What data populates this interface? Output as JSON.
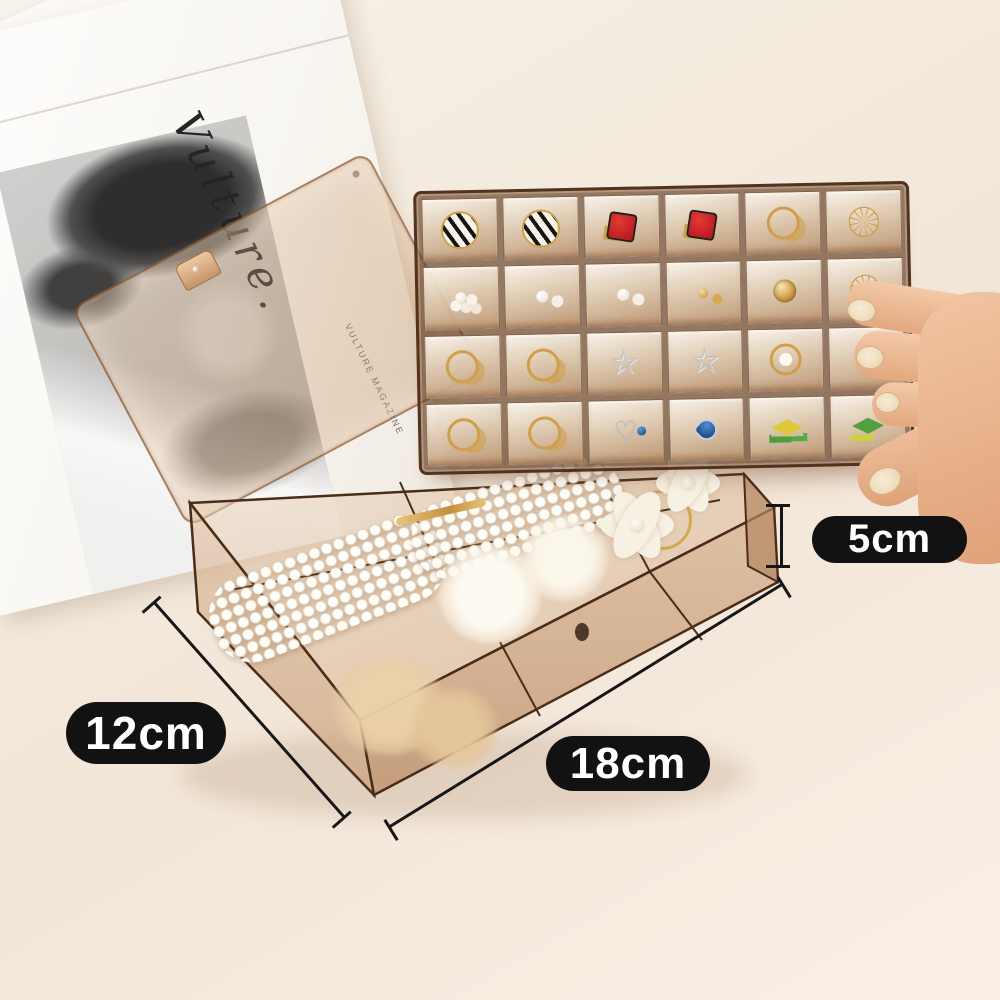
{
  "annotations": {
    "height_label": "5cm",
    "side_label": "12cm",
    "front_label": "18cm"
  },
  "magazine": {
    "script_title": "Vulture.",
    "caption": "VULTURE MAGAZINE"
  },
  "tray": {
    "rows": 4,
    "cols": 6,
    "items": [
      "striped-circle",
      "striped-circle",
      "red-square",
      "red-square",
      "gold-hoop",
      "wire-ball",
      "pearl-cluster",
      "pearl-stud",
      "pearl-stud",
      "gold-stud",
      "gold-ball",
      "wire-ball",
      "gold-hoop",
      "gold-hoop",
      "silver-star",
      "silver-star",
      "gold-flower",
      "gold-crystal",
      "gold-hoop",
      "gold-hoop",
      "silver-heart",
      "blue-gem",
      "yellow-bow",
      "green-bow"
    ]
  },
  "box": {
    "items": [
      "pearl-barrette",
      "pearl-barrette",
      "gold-clip",
      "gold-ring-tie",
      "flower-hair-ties",
      "fur-pom-poms",
      "beige-scrunchie"
    ]
  },
  "icons": {
    "silver-star": "☆",
    "silver-heart": "♡"
  },
  "colors": {
    "background": "#f4ebdf",
    "plastic_amber": "#c39a72",
    "plastic_edge": "#4a2c18",
    "label_bg": "#121212",
    "label_text": "#ffffff",
    "gold": "#cf9f4b",
    "pearl": "#f7f1e8",
    "red_earring": "#c01820",
    "silver": "#c3c6cf",
    "blue_gem": "#123c7a",
    "bow_yellow": "#ddc938",
    "bow_green": "#53a03f",
    "skin": "#eebf9f"
  }
}
